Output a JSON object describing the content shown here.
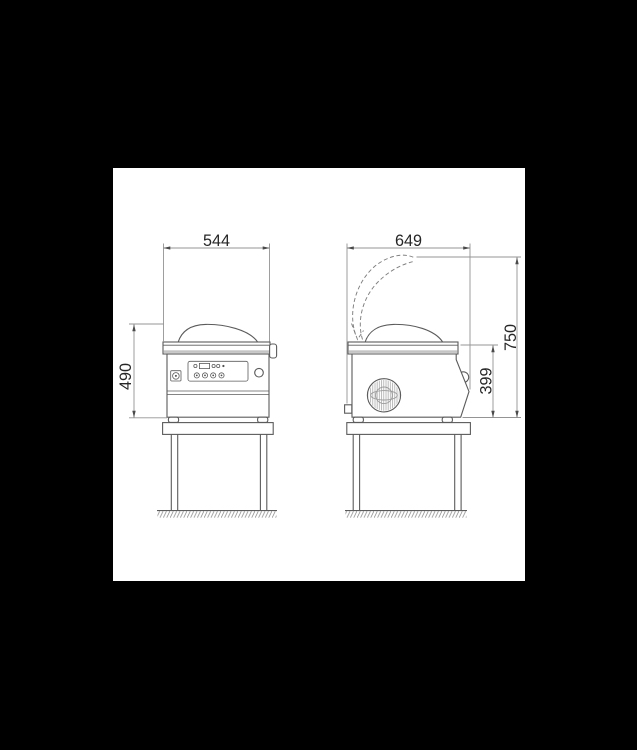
{
  "scene": {
    "type": "technical dimension drawing",
    "subject": "chamber vacuum packaging machine on a stand, front view and side view with open-lid outline"
  },
  "dimensions": {
    "front_width": "544",
    "front_height": "490",
    "side_depth": "649",
    "side_height_open": "750",
    "side_body_height": "399"
  },
  "colors": {
    "background": "#000000",
    "paper": "#ffffff",
    "machine_line": "#5b5b5b",
    "dimension_line": "#949494",
    "text": "#262626"
  }
}
